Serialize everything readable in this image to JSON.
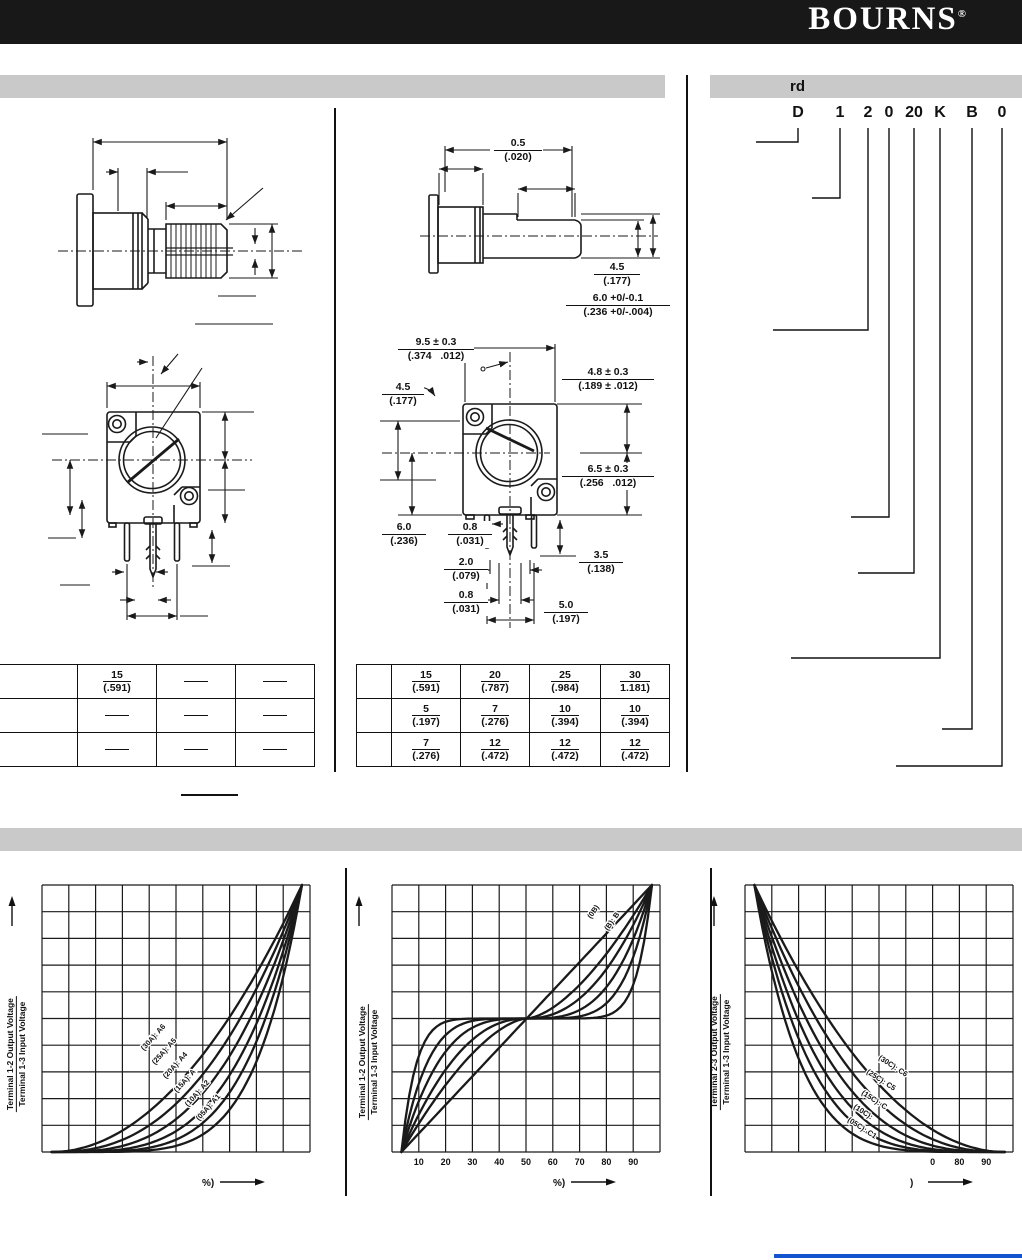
{
  "header": {
    "logo": "BOURNS",
    "registered": "®"
  },
  "bars": {
    "left_section_title": "",
    "order_section_title": "rd",
    "taper_section_title": ""
  },
  "part_number": {
    "chars": [
      "D",
      "1",
      "2",
      "0",
      "20",
      "K",
      "B",
      "0"
    ]
  },
  "dims_side": [
    {
      "top": "0.5",
      "bottom": "(.020)"
    },
    {
      "top": "4.5",
      "bottom": "(.177)"
    },
    {
      "top": "6.0 +0/-0.1",
      "bottom": "(.236 +0/-.004)"
    }
  ],
  "dims_front": [
    {
      "top": "9.5 ± 0.3",
      "bottom": "(.374   .012)"
    },
    {
      "top": "4.5",
      "bottom": "(.177)"
    },
    {
      "top": "4.8 ± 0.3",
      "bottom": "(.189 ± .012)"
    },
    {
      "top": "6.5 ± 0.3",
      "bottom": "(.256   .012)"
    },
    {
      "top": "6.0",
      "bottom": "(.236)"
    },
    {
      "top": "0.8",
      "bottom": "(.031)"
    },
    {
      "top": "2.0",
      "bottom": "(.079)"
    },
    {
      "top": "0.8",
      "bottom": "(.031)"
    },
    {
      "top": "3.5",
      "bottom": "(.138)"
    },
    {
      "top": "5.0",
      "bottom": "(.197)"
    }
  ],
  "table_left": {
    "rows": [
      [
        "",
        {
          "top": "15",
          "bottom": "(.591)"
        },
        "dash",
        "dash"
      ],
      [
        "",
        "dash",
        "dash",
        "dash"
      ],
      [
        "",
        "dash",
        "dash",
        "dash"
      ]
    ]
  },
  "table_right": {
    "rows": [
      [
        "",
        {
          "top": "15",
          "bottom": "(.591)"
        },
        {
          "top": "20",
          "bottom": "(.787)"
        },
        {
          "top": "25",
          "bottom": "(.984)"
        },
        {
          "top": "30",
          "bottom": "1.181)"
        }
      ],
      [
        "",
        {
          "top": "5",
          "bottom": "(.197)"
        },
        {
          "top": "7",
          "bottom": "(.276)"
        },
        {
          "top": "10",
          "bottom": "(.394)"
        },
        {
          "top": "10",
          "bottom": "(.394)"
        }
      ],
      [
        "",
        {
          "top": "7",
          "bottom": "(.276)"
        },
        {
          "top": "12",
          "bottom": "(.472)"
        },
        {
          "top": "12",
          "bottom": "(.472)"
        },
        {
          "top": "12",
          "bottom": "(.472)"
        }
      ]
    ]
  },
  "chart_data": [
    {
      "type": "line",
      "title": "",
      "ylabel_numerator": "Terminal 1-2 Output Voltage",
      "ylabel_denominator": "Terminal 1-3 Input Voltage",
      "xlabel": "%)",
      "taper_family": "audio",
      "xlim": [
        0,
        100
      ],
      "ylim": [
        0,
        100
      ],
      "grid": "10x10",
      "curve_exponents": [
        2.0,
        2.45,
        3.0,
        3.65,
        4.4,
        5.4
      ],
      "curve_labels": [
        "(30A): A6",
        "(25A): A5",
        "(20A): A4",
        "(15A): A",
        "(10A): A2",
        "(05A): A1"
      ],
      "x_ticks": []
    },
    {
      "type": "line",
      "title": "",
      "ylabel_numerator": "Terminal 1-2 Output Voltage",
      "ylabel_denominator": "Terminal 1-3 Input Voltage",
      "xlabel": "%)",
      "taper_family": "s-curve",
      "xlim": [
        0,
        100
      ],
      "ylim": [
        0,
        100
      ],
      "grid": "10x10",
      "curve_exponents": [
        1,
        1.6,
        2.2,
        3.2,
        4.8,
        8.5
      ],
      "curve_labels": [
        "(0B)",
        "(B): B"
      ],
      "x_ticks": [
        {
          "pos": 10,
          "label": "10"
        },
        {
          "pos": 20,
          "label": "20"
        },
        {
          "pos": 30,
          "label": "30"
        },
        {
          "pos": 40,
          "label": "40"
        },
        {
          "pos": 50,
          "label": "50"
        },
        {
          "pos": 60,
          "label": "60"
        },
        {
          "pos": 70,
          "label": "70"
        },
        {
          "pos": 80,
          "label": "80"
        },
        {
          "pos": 90,
          "label": "90"
        }
      ]
    },
    {
      "type": "line",
      "title": "",
      "ylabel_numerator": "Terminal 2-3 Output Voltage",
      "ylabel_denominator": "Terminal 1-3 Input Voltage",
      "xlabel": ")",
      "taper_family": "reverse-audio",
      "xlim": [
        0,
        100
      ],
      "ylim": [
        0,
        100
      ],
      "grid": "10x10",
      "curve_exponents": [
        2.0,
        2.45,
        3.0,
        3.65,
        4.4,
        5.4
      ],
      "curve_labels": [
        "(30C): C6",
        "(25C): C5",
        "(15C): C",
        "(10C):",
        "(05C): C1"
      ],
      "x_ticks": [
        {
          "pos": 70,
          "label": "0"
        },
        {
          "pos": 80,
          "label": "80"
        },
        {
          "pos": 90,
          "label": "90"
        }
      ]
    }
  ]
}
